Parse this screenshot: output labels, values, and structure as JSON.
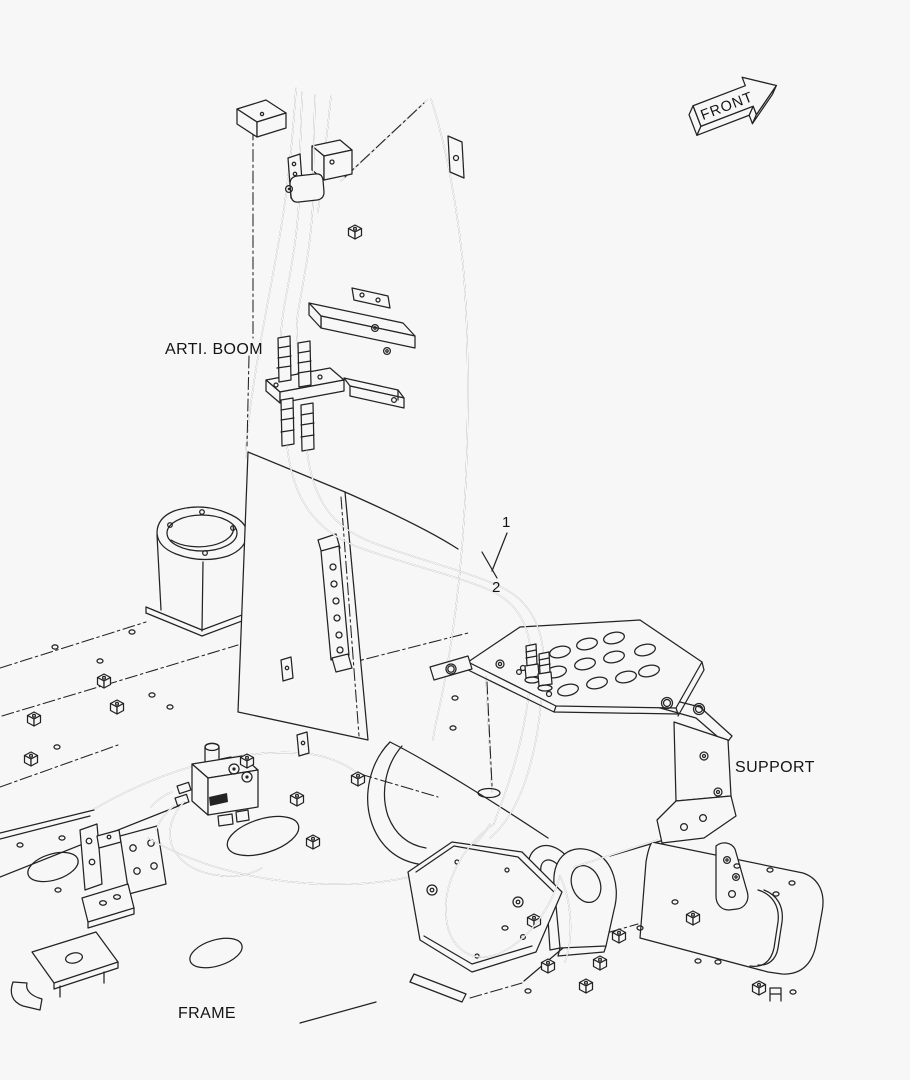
{
  "diagram": {
    "type": "exploded-parts-line-drawing",
    "labels": {
      "arti_boom": "ARTI. BOOM",
      "support": "SUPPORT",
      "frame": "FRAME",
      "front": "FRONT"
    },
    "callouts": [
      {
        "number": "1"
      },
      {
        "number": "2"
      }
    ],
    "colors": {
      "line": "#232323",
      "background": "#f7f7f7"
    }
  }
}
